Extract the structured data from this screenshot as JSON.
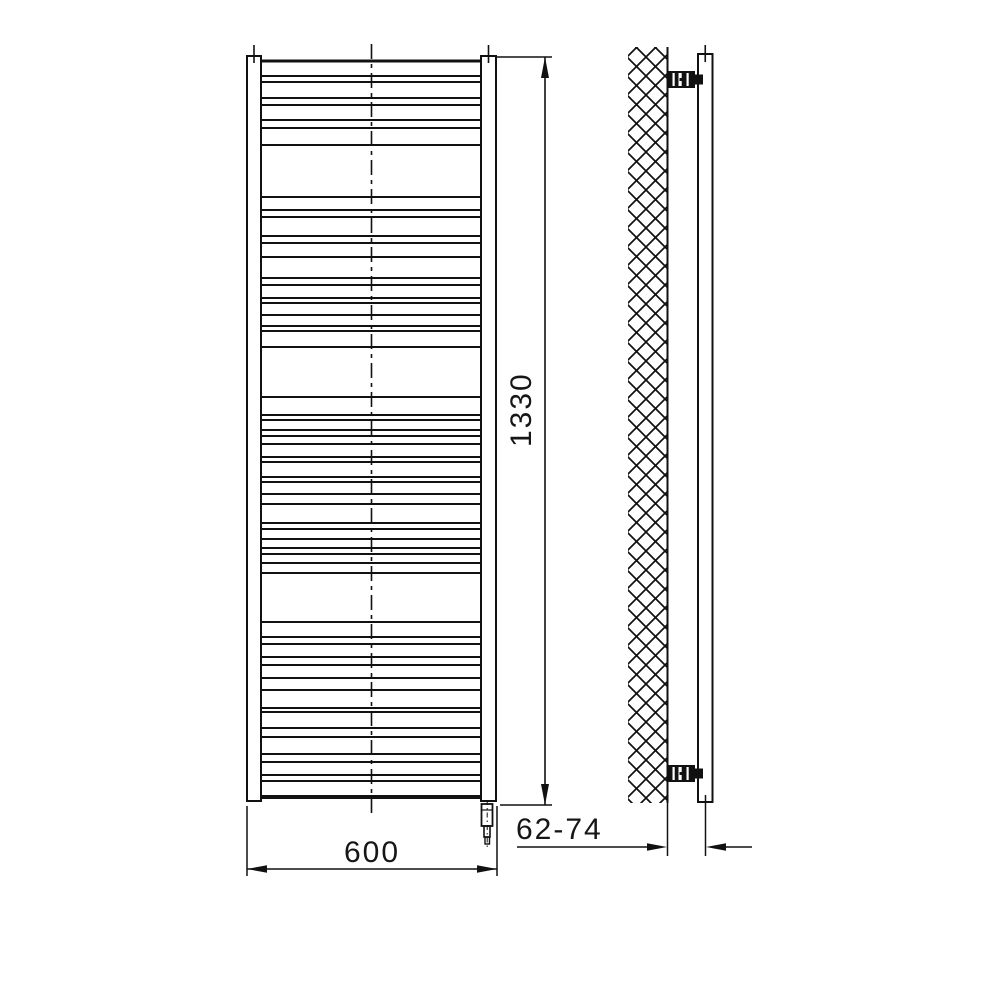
{
  "drawing": {
    "type": "technical-dimension-drawing",
    "subject": "towel radiator with electric heating element, front and side view",
    "ink_color": "#111111",
    "background_color": "#ffffff"
  },
  "dimensions": {
    "height_label": "1330",
    "width_label": "600",
    "depth_label": "62-74"
  },
  "front_view": {
    "top_header_y": 61,
    "bottom_header_y": 797,
    "rung_x1": 261,
    "rung_x2": 481,
    "rungs": [
      76,
      82,
      98,
      105,
      120,
      128,
      145,
      197,
      210,
      217,
      236,
      243,
      257,
      278,
      285,
      298,
      303,
      315,
      326,
      331,
      347,
      397,
      415,
      420,
      430,
      436,
      444,
      457,
      462,
      477,
      482,
      494,
      504,
      523,
      529,
      539,
      548,
      554,
      563,
      573,
      622,
      637,
      644,
      657,
      665,
      678,
      690,
      708,
      712,
      728,
      737,
      754,
      762,
      775,
      781
    ]
  }
}
